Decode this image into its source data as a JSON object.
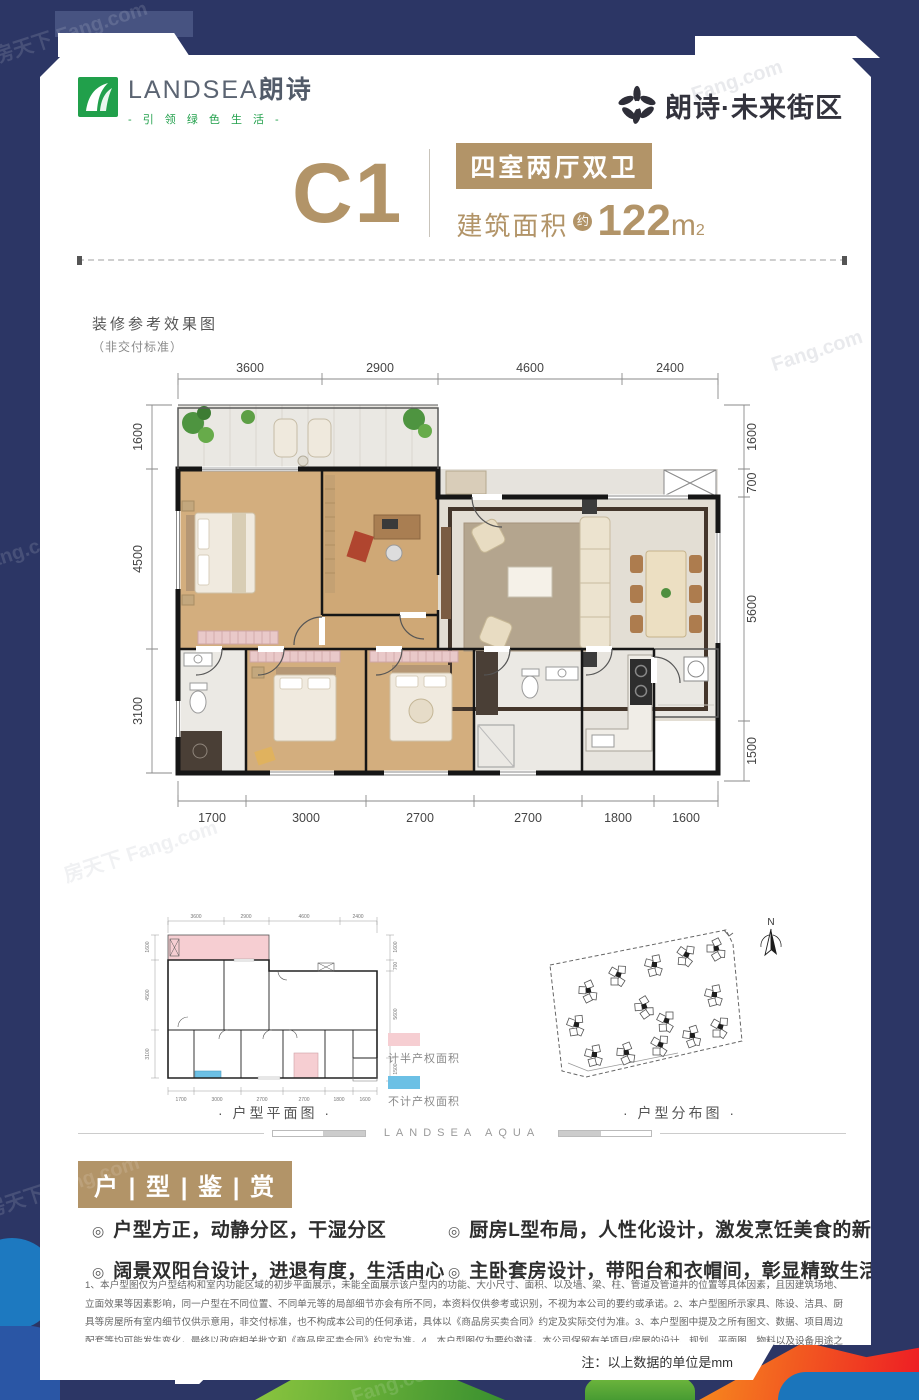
{
  "brand_left": {
    "name_en": "LANDSEA",
    "name_cn": "朗诗",
    "slogan": "-  引 领 绿 色 生 活  -"
  },
  "brand_right": {
    "name": "朗诗·未来街区"
  },
  "title": {
    "unit": "C1",
    "layout": "四室两厅双卫",
    "area_label": "建筑面积",
    "approx": "约",
    "area_value": "122",
    "area_unit": "m",
    "area_sup": "2"
  },
  "render_note": {
    "line1": "装修参考效果图",
    "line2": "（非交付标准）"
  },
  "floorplan": {
    "dims_top": [
      "3600",
      "2900",
      "4600",
      "2400"
    ],
    "dims_left": [
      "1600",
      "4500",
      "3100"
    ],
    "dims_right": [
      "1600",
      "700",
      "5600",
      "1500"
    ],
    "dims_bottom": [
      "1700",
      "3000",
      "2700",
      "2700",
      "1800",
      "1600"
    ]
  },
  "miniplan": {
    "caption": "·  户型平面图  ·",
    "legend": [
      {
        "label": "计半产权面积"
      },
      {
        "label": "不计产权面积"
      }
    ]
  },
  "siteplan": {
    "caption": "·  户型分布图  ·",
    "north_label": "N"
  },
  "section_divider": {
    "text": "LANDSEA AQUA"
  },
  "appreciation": {
    "badge": "户 | 型 | 鉴 | 赏",
    "bullet_icon": "◎",
    "bullets_left": [
      "户型方正，动静分区，干湿分区",
      "阔景双阳台设计，进退有度，生活由心"
    ],
    "bullets_right": [
      "厨房L型布局，人性化设计，激发烹饪美食的新鲜灵感",
      "主卧套房设计，带阳台和衣帽间，彰显精致生活品位"
    ]
  },
  "disclaimer": {
    "text": "1、本户型图仅为户型结构和室内功能区域的初步平面展示，未能全面展示该户型内的功能、大小尺寸、面积、以及墙、梁、柱、管道及管道井的位置等具体因素，且因建筑场地、立面效果等因素影响，同一户型在不同位置、不同单元等的局部细节亦会有所不同，本资料仅供参考或识别，不视为本公司的要约或承诺。2、本户型图所示家具、陈设、洁具、厨具等房屋所有室内细节仅供示意用，非交付标准，也不构成本公司的任何承诺，具体以《商品房买卖合同》约定及实际交付为准。3、本户型图中提及之所有图文、数据、项目周边配套等均可能发生变化，最终以政府相关批文和《商品房买卖合同》约定为准。4、本户型图仅为要约邀请，本公司保留有关项目/房屋的设计、规划、平面图、物料以及设备用途之改动权，且事前将不会另行通知，敬请留意最新资料。本资料印刷制作时间为【2019年7月第1次印刷】，如有版本更新，原版本自动失效。全国客户热线：400-8811-580"
  },
  "footnote": {
    "text": "注：以上数据的单位是mm"
  },
  "watermark": {
    "text": "房天下 Fang.com",
    "text_short": "Fang.com"
  },
  "colors": {
    "gold": "#b29468",
    "navy": "#2c3665",
    "brand_green": "#21a04b",
    "legend_pink": "#f6ced2",
    "legend_blue": "#6cc0e5"
  }
}
